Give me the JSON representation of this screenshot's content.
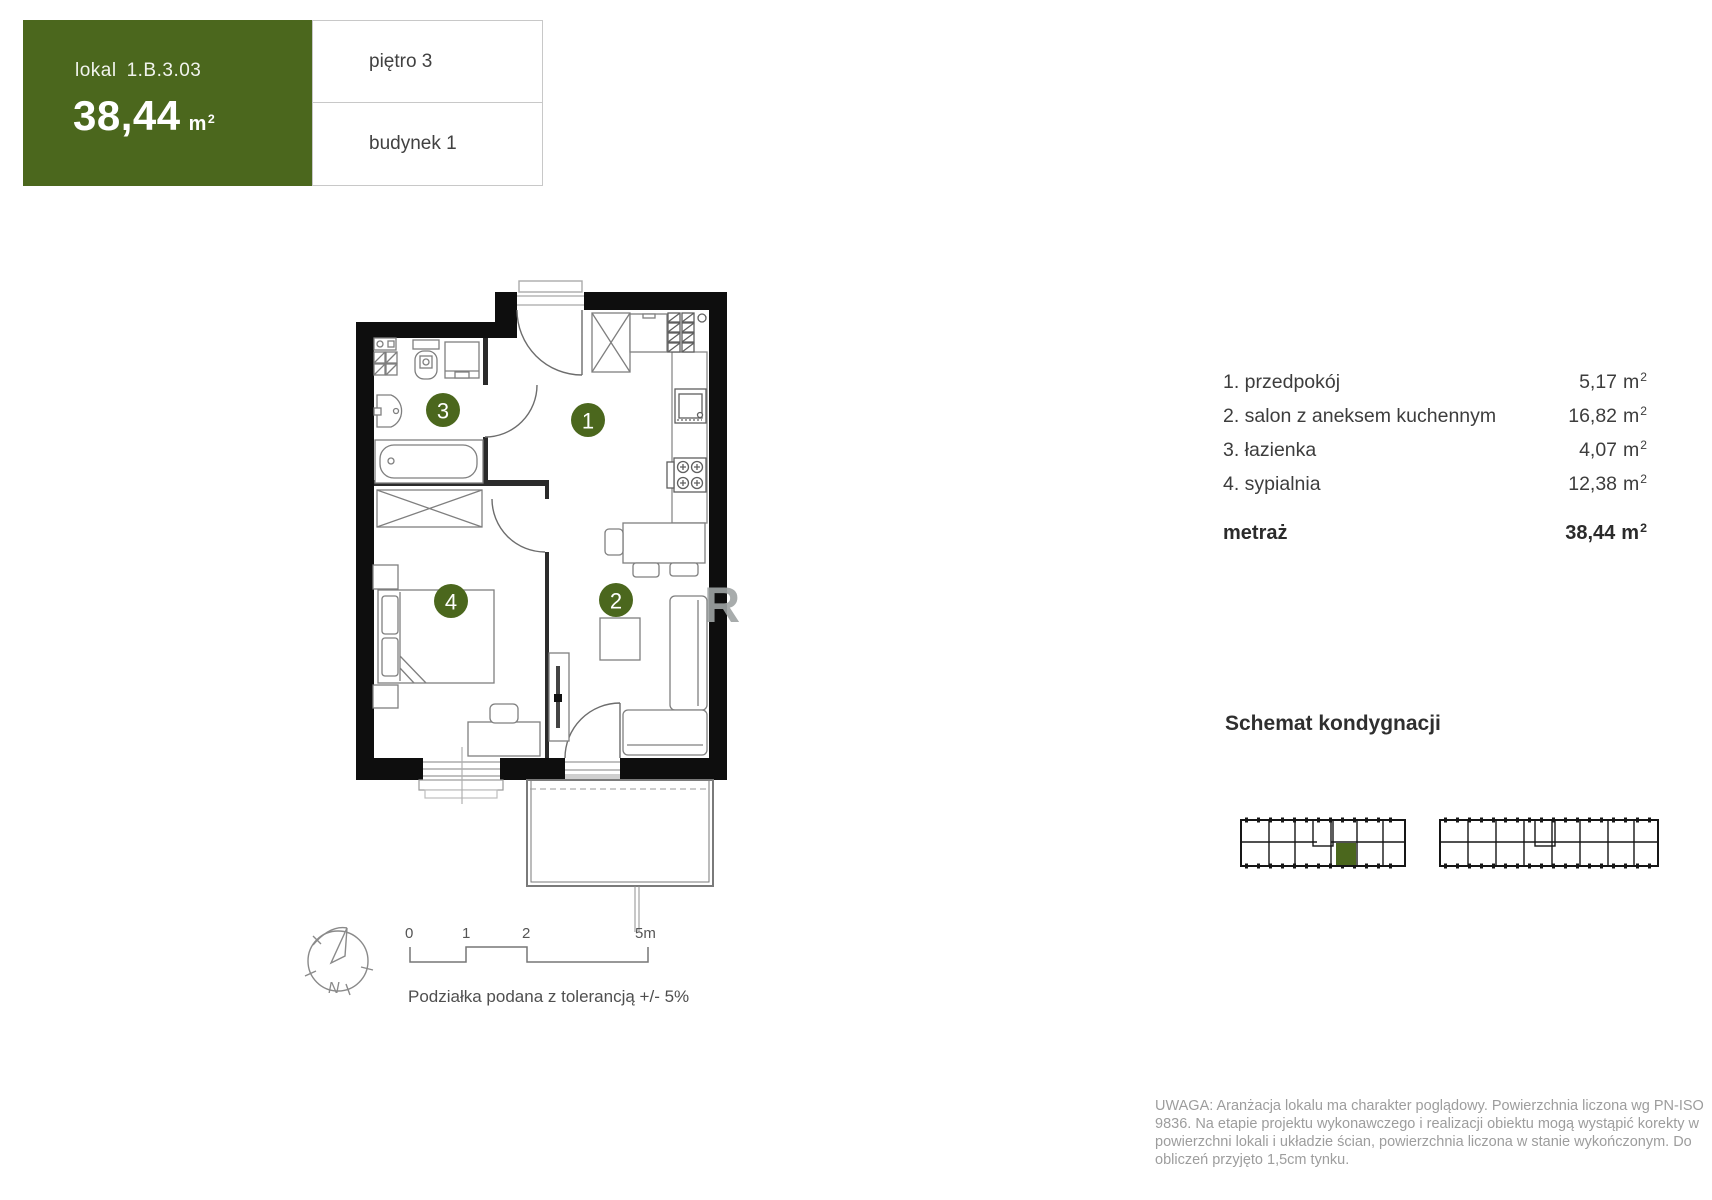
{
  "header": {
    "unit_label": "lokal",
    "unit_id": "1.B.3.03",
    "area": "38,44",
    "floor": "piętro 3",
    "building": "budynek 1"
  },
  "units": {
    "m": "m",
    "exp": "2"
  },
  "room_list": {
    "rows": [
      {
        "name": "1. przedpokój",
        "area": "5,17"
      },
      {
        "name": "2. salon z aneksem kuchennym",
        "area": "16,82"
      },
      {
        "name": "3. łazienka",
        "area": "4,07"
      },
      {
        "name": "4. sypialnia",
        "area": "12,38"
      }
    ],
    "total_label": "metraż",
    "total_area": "38,44"
  },
  "schematic_title": "Schemat kondygnacji",
  "plan": {
    "markers": [
      {
        "n": "1"
      },
      {
        "n": "2"
      },
      {
        "n": "3"
      },
      {
        "n": "4"
      }
    ],
    "watermark": "R",
    "compass": {
      "label": "N"
    },
    "scale": {
      "t0": "0",
      "t1": "1",
      "t2": "2",
      "t3": "5m",
      "caption": "Podziałka podana z tolerancją +/- 5%"
    }
  },
  "disclaimer": "UWAGA: Aranżacja lokalu ma charakter poglądowy. Powierzchnia liczona wg PN-ISO 9836. Na etapie projektu wykonawczego i realizacji obiektu mogą wystąpić korekty w powierzchni lokali i układzie ścian, powierzchnia liczona w stanie wykończonym. Do obliczeń przyjęto 1,5cm tynku.",
  "colors": {
    "accent_green": "#4b671d"
  }
}
